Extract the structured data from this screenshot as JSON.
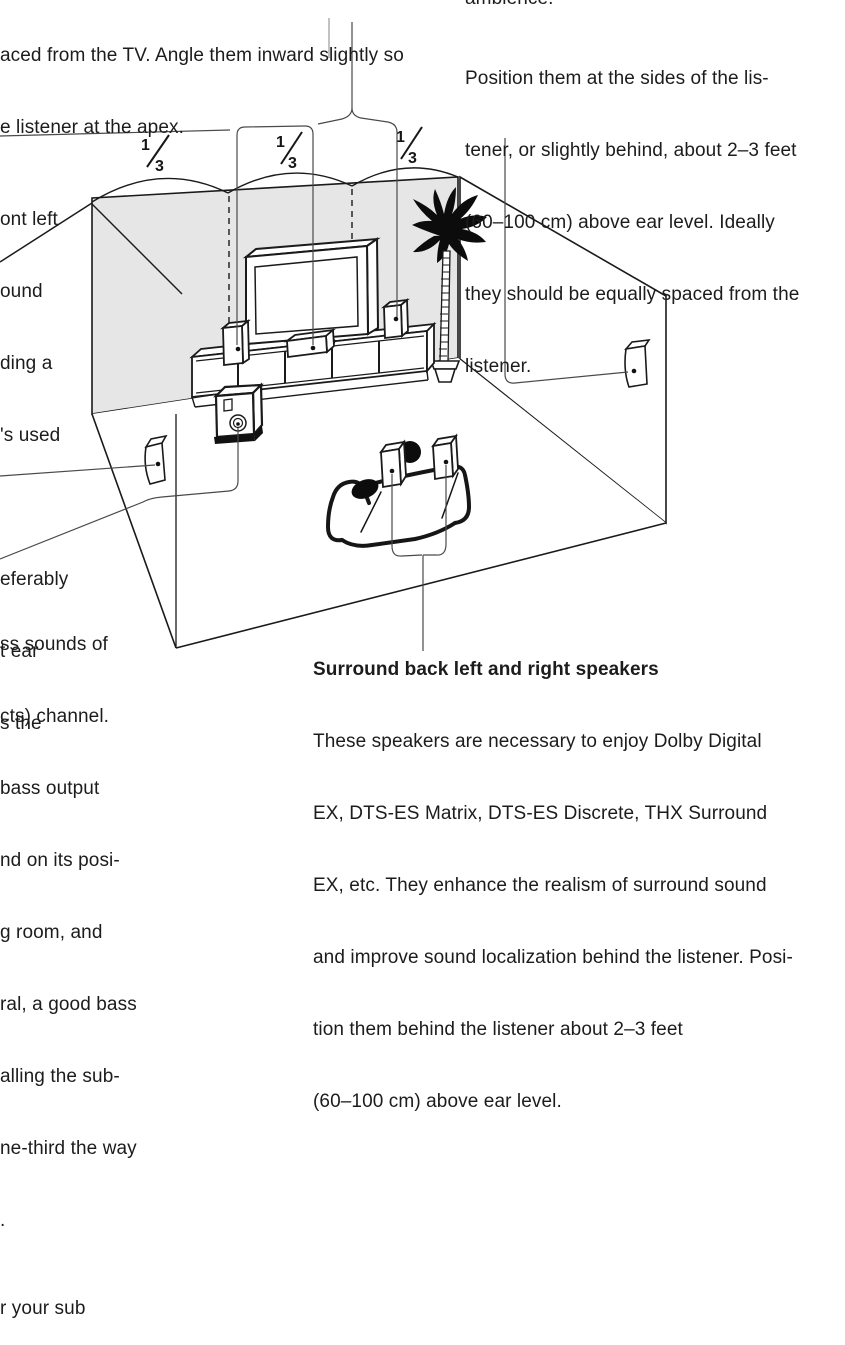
{
  "top_left": {
    "lines": [
      "aced from the TV. Angle them inward slightly so",
      "e listener at the apex."
    ]
  },
  "top_right": {
    "clipped_line": "ambience.",
    "lines": [
      "Position them at the sides of the lis-",
      "tener, or slightly behind, about 2–3 feet",
      "(60–100 cm) above ear level. Ideally",
      "they should be equally spaced from the",
      "listener."
    ]
  },
  "mid_left_fragments": [
    "ont left",
    "ound",
    "ding a",
    "'s used",
    "",
    "eferably",
    "t ear",
    "s the"
  ],
  "bottom_left_fragments": [
    "ss sounds of",
    "cts) channel.",
    "bass output",
    "nd on its posi-",
    "g room, and",
    "ral, a good bass",
    "alling the sub-",
    "ne-third the way",
    ".",
    "r your sub"
  ],
  "bottom_right": {
    "heading": "Surround back left and right speakers",
    "lines": [
      "These speakers are necessary to enjoy Dolby Digital",
      "EX, DTS-ES Matrix, DTS-ES Discrete, THX Surround",
      "EX, etc. They enhance the realism of surround sound",
      "and improve sound localization behind the listener. Posi-",
      "tion them behind the listener about 2–3 feet",
      "(60–100 cm) above ear level."
    ]
  },
  "diagram": {
    "fractions": [
      {
        "num": "1",
        "den": "3"
      },
      {
        "num": "1",
        "den": "3"
      },
      {
        "num": "1",
        "den": "3"
      }
    ],
    "wall_color": "#e6e6e6",
    "line_color": "#1a1a1a",
    "callout_color": "#4a4a4a"
  }
}
